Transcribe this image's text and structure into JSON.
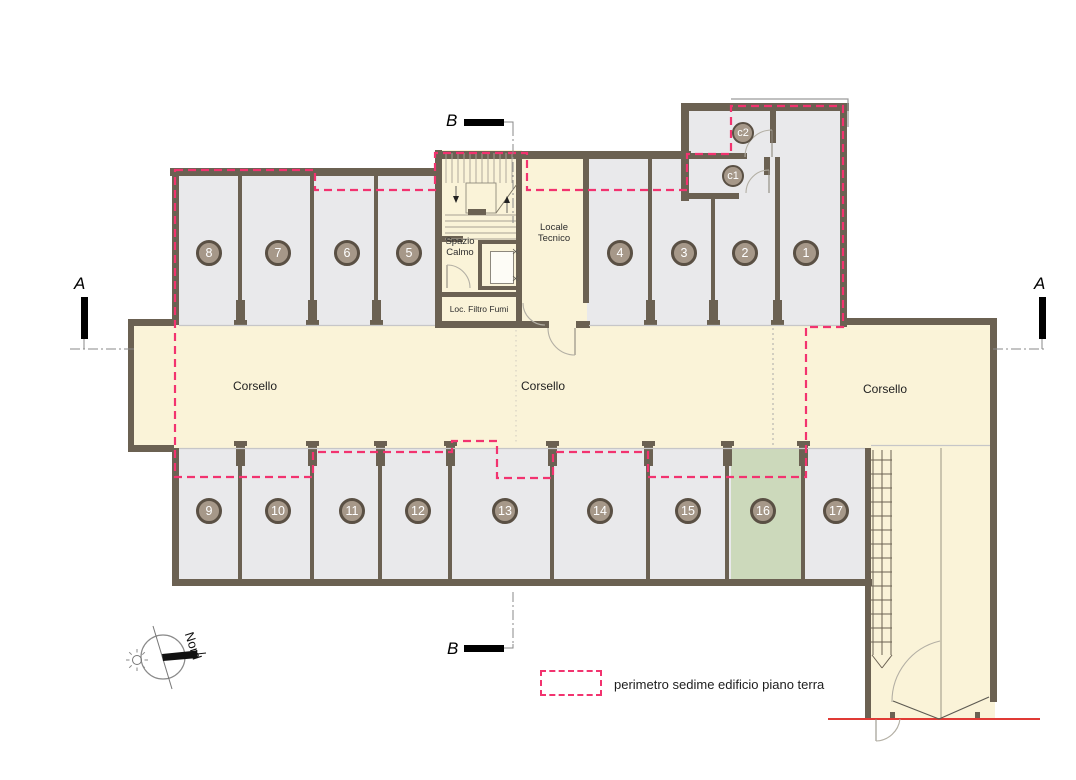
{
  "colors": {
    "stall_fill": "#e9e9eb",
    "circulation_fill": "#faf3d8",
    "wall": "#6b6152",
    "highlight_stall_fill": "#ccd9bb",
    "perimeter_dash": "#f2336f",
    "ground_line_red": "#e03a35",
    "badge_fill": "#a69889",
    "badge_border": "#5a5044"
  },
  "stalls": {
    "top": [
      "8",
      "7",
      "6",
      "5",
      "4",
      "3",
      "2",
      "1"
    ],
    "bottom": [
      "9",
      "10",
      "11",
      "12",
      "13",
      "14",
      "15",
      "16",
      "17"
    ],
    "cellars": [
      "c2",
      "c1"
    ],
    "highlighted_stall": "16"
  },
  "rooms": {
    "spazio_calmo_line1": "Spazio",
    "spazio_calmo_line2": "Calmo",
    "locale_tecnico_line1": "Locale",
    "locale_tecnico_line2": "Tecnico",
    "filtro_fumi": "Loc. Filtro Fumi"
  },
  "corsello": {
    "left": "Corsello",
    "center": "Corsello",
    "right": "Corsello"
  },
  "sections": {
    "a": "A",
    "b": "B"
  },
  "compass": {
    "north_label": "Nord"
  },
  "legend": {
    "perimeter_label": "perimetro sedime edificio piano terra"
  }
}
